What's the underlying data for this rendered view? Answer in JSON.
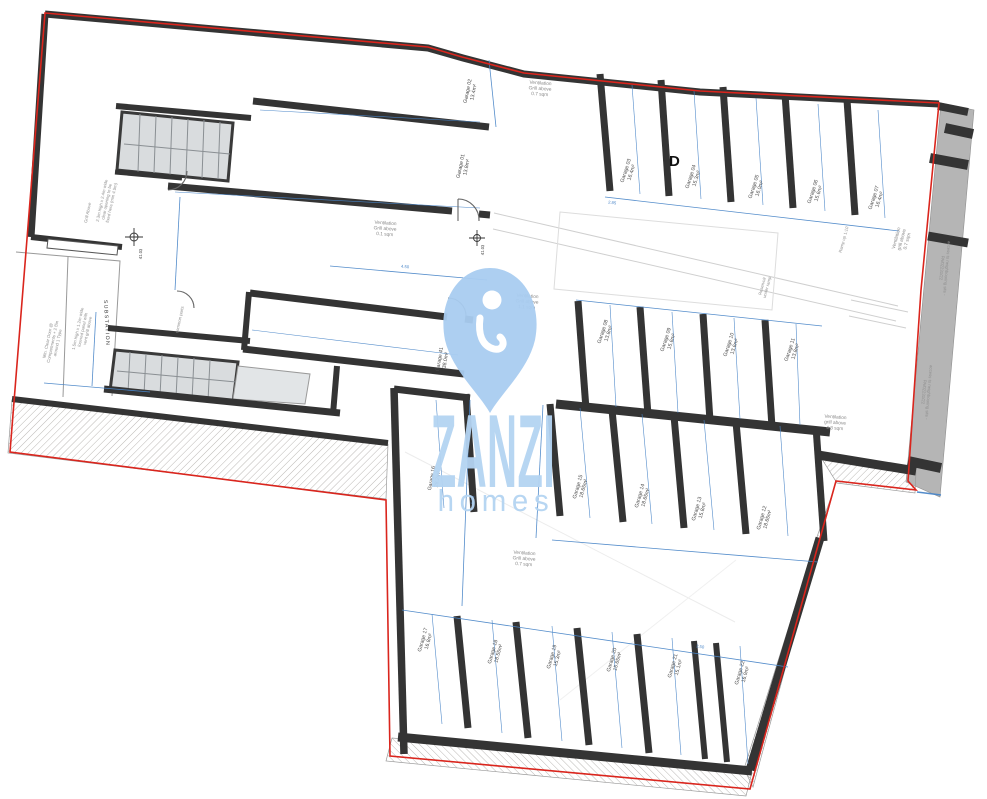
{
  "title": "Basement garage floor plan",
  "brand": {
    "name": "ZANZI",
    "tagline": "homes"
  },
  "colors": {
    "wall": "#343434",
    "boundary_red": "#da251d",
    "dim_blue": "#4a86c8",
    "watermark_blue": "#a9cdf1",
    "watermark_text": "#b4d4f2",
    "neighbour_gray": "#b5b5b5",
    "stair_gray": "#d9dcde"
  },
  "plan": {
    "garage_labels": [
      {
        "name": "Garage 02",
        "area": "13.4m²",
        "x": 472,
        "y": 92,
        "rot": -78
      },
      {
        "name": "Garage 01",
        "area": "13.8m²",
        "x": 465,
        "y": 167,
        "rot": -78
      },
      {
        "name": "Garage 03",
        "area": "16.4m²",
        "x": 630,
        "y": 172,
        "rot": -72
      },
      {
        "name": "Garage 04",
        "area": "15.3m²",
        "x": 695,
        "y": 178,
        "rot": -72
      },
      {
        "name": "Garage 05",
        "area": "16.0m²",
        "x": 758,
        "y": 188,
        "rot": -72
      },
      {
        "name": "Garage 06",
        "area": "15.6m²",
        "x": 817,
        "y": 193,
        "rot": -72
      },
      {
        "name": "Garage 07",
        "area": "16.4m²",
        "x": 878,
        "y": 199,
        "rot": -72
      },
      {
        "name": "Garage 08",
        "area": "13.8m²",
        "x": 607,
        "y": 333,
        "rot": -72
      },
      {
        "name": "Garage 09",
        "area": "15.6m²",
        "x": 670,
        "y": 341,
        "rot": -72
      },
      {
        "name": "Garage 10",
        "area": "13.6m²",
        "x": 733,
        "y": 346,
        "rot": -72
      },
      {
        "name": "Garage 11",
        "area": "13.8m²",
        "x": 794,
        "y": 351,
        "rot": -72
      },
      {
        "name": "Garage 41",
        "area": "38.0m²",
        "x": 444,
        "y": 360,
        "rot": -80
      },
      {
        "name": "Garage 16",
        "area": "28.2m²",
        "x": 436,
        "y": 479,
        "rot": -80
      },
      {
        "name": "Garage 15",
        "area": "18.65m²",
        "x": 582,
        "y": 488,
        "rot": -74
      },
      {
        "name": "Garage 14",
        "area": "18.65m²",
        "x": 644,
        "y": 497,
        "rot": -74
      },
      {
        "name": "Garage 13",
        "area": "15.8m²",
        "x": 701,
        "y": 510,
        "rot": -74
      },
      {
        "name": "Garage 12",
        "area": "18.65m²",
        "x": 766,
        "y": 519,
        "rot": -74
      },
      {
        "name": "Garage 17",
        "area": "16.8m²",
        "x": 427,
        "y": 641,
        "rot": -74
      },
      {
        "name": "Garage 18",
        "area": "18.55m²",
        "x": 497,
        "y": 653,
        "rot": -74
      },
      {
        "name": "Garage 19",
        "area": "15.3m²",
        "x": 556,
        "y": 658,
        "rot": -74
      },
      {
        "name": "Garage 20",
        "area": "15.65m²",
        "x": 616,
        "y": 661,
        "rot": -74
      },
      {
        "name": "Garage 21",
        "area": "15.1m²",
        "x": 677,
        "y": 667,
        "rot": -74
      },
      {
        "name": "Garage 22",
        "area": "16.9m²",
        "x": 744,
        "y": 674,
        "rot": -74
      }
    ],
    "ventilation_notes": [
      {
        "lines": [
          "Ventilation",
          "Grill above",
          "0.7 sqm"
        ],
        "x": 540,
        "y": 90,
        "rot": 4
      },
      {
        "lines": [
          "Ventilation",
          "Grill above",
          "0.1 sqm"
        ],
        "x": 385,
        "y": 230,
        "rot": 4
      },
      {
        "lines": [
          "Ventilation",
          "Grill above",
          "1.1 sqm"
        ],
        "x": 527,
        "y": 303,
        "rot": 4
      },
      {
        "lines": [
          "Ventilation",
          "grill above",
          "0.7 sqm"
        ],
        "x": 903,
        "y": 240,
        "rot": -75
      },
      {
        "lines": [
          "Ventilation",
          "grill above",
          "4.3 sqm"
        ],
        "x": 835,
        "y": 424,
        "rot": 4
      },
      {
        "lines": [
          "Ventilation",
          "Grill above",
          "0.7 sqm"
        ],
        "x": 524,
        "y": 560,
        "rot": 4
      }
    ],
    "side_notes": [
      {
        "lines": [
          "access to neighbouring site -",
          "PA/02231/22"
        ],
        "x": 943,
        "y": 268,
        "rot": 95
      },
      {
        "lines": [
          "access to neighbouring site -",
          "PA/02231/22"
        ],
        "x": 925,
        "y": 392,
        "rot": 95
      },
      {
        "lines": [
          "Grill Above"
        ],
        "x": 89,
        "y": 213,
        "rot": -78
      },
      {
        "lines": [
          "2.3m high x 2.4m wide",
          "clear opening to be",
          "fixed here (min 4.5m)"
        ],
        "x": 108,
        "y": 202,
        "rot": -78
      },
      {
        "lines": [
          "1.5m high x 1.2m wide",
          "louvred panel with",
          "vent grill above"
        ],
        "x": 84,
        "y": 330,
        "rot": -78
      },
      {
        "lines": [
          "Min. Clear Door @",
          "Compartments + 2 Bin",
          "around 1 Type"
        ],
        "x": 54,
        "y": 342,
        "rot": -78
      },
      {
        "lines": [
          "Reservoir",
          "under ramp"
        ],
        "x": 766,
        "y": 287,
        "rot": -75
      },
      {
        "lines": [
          "Ramp up 1:10"
        ],
        "x": 845,
        "y": 240,
        "rot": -75
      },
      {
        "lines": [
          "common parts"
        ],
        "x": 181,
        "y": 320,
        "rot": -78
      }
    ],
    "dimension_labels": [
      {
        "text": "4.50",
        "x": 405,
        "y": 268,
        "rot": 5
      },
      {
        "text": "2.85",
        "x": 612,
        "y": 204,
        "rot": 7
      },
      {
        "text": "5.96",
        "x": 474,
        "y": 500,
        "rot": -84
      },
      {
        "text": "2.50",
        "x": 700,
        "y": 648,
        "rot": 8
      }
    ],
    "spot_levels": [
      {
        "text": "41.03",
        "x": 142,
        "y": 254,
        "rot": -88
      },
      {
        "text": "41.03",
        "x": 484,
        "y": 250,
        "rot": -88
      }
    ],
    "markers": {
      "section_d": "D",
      "substation": "SUBSTATION"
    }
  }
}
